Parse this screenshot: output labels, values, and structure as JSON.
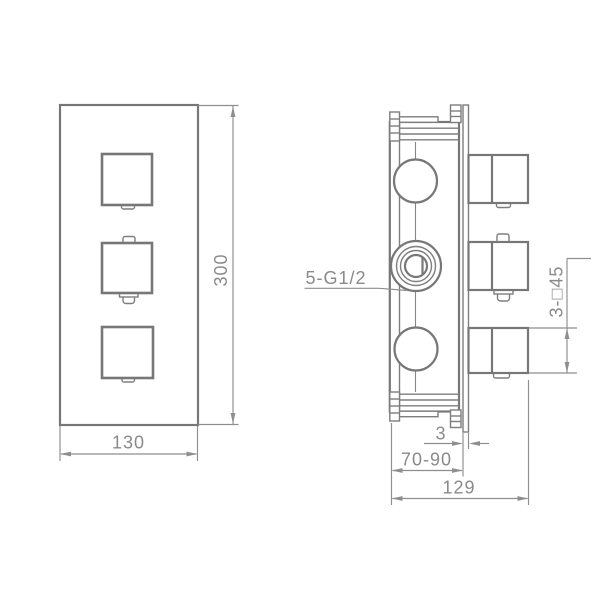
{
  "drawing": {
    "front_view": {
      "width": "130",
      "height": "300"
    },
    "side_view": {
      "port_thread": "5-G1/2",
      "handle_square": "3-□45",
      "plate_thickness": "3",
      "mount_depth_range": "70-90",
      "overall_depth": "129"
    },
    "colors": {
      "background": "#ffffff",
      "outline": "#777777",
      "detail": "#7e7e7e",
      "dimension": "#8e8e8e",
      "text": "#8a8a8a"
    }
  }
}
